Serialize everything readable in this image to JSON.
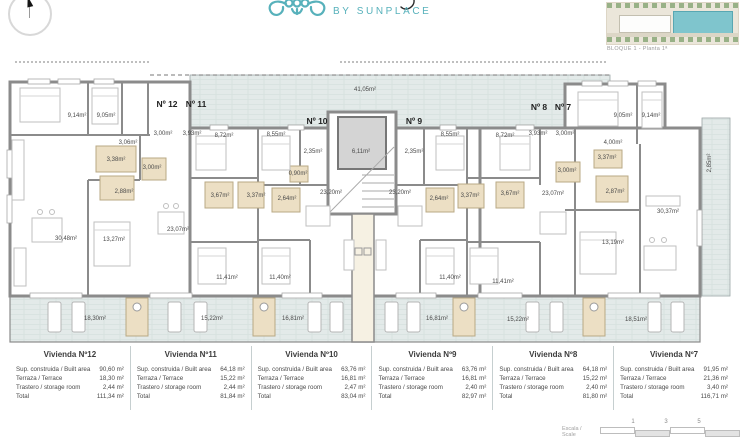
{
  "brand": {
    "tagline": "BY SUNPLACE",
    "accent_color": "#57b1bb"
  },
  "sitemap": {
    "caption": "BLOQUE 1 - Planta 1ª",
    "highlight_color": "#7fc5cd"
  },
  "colors": {
    "wall": "#8b8b8b",
    "terrace_fill": "#e3eae9",
    "bath_fill": "#ecdfc4"
  },
  "plan": {
    "unit_labels": [
      {
        "t": "Nº 12",
        "x": 167,
        "y": 104
      },
      {
        "t": "Nº 11",
        "x": 196,
        "y": 104
      },
      {
        "t": "Nº 10",
        "x": 317,
        "y": 121
      },
      {
        "t": "Nº 9",
        "x": 414,
        "y": 121
      },
      {
        "t": "Nº 8",
        "x": 539,
        "y": 107
      },
      {
        "t": "Nº 7",
        "x": 563,
        "y": 107
      }
    ],
    "room_labels": [
      {
        "t": "9,14m²",
        "x": 77,
        "y": 116
      },
      {
        "t": "9,05m²",
        "x": 106,
        "y": 116
      },
      {
        "t": "3,06m²",
        "x": 128,
        "y": 143
      },
      {
        "t": "3,38m²",
        "x": 116,
        "y": 160
      },
      {
        "t": "2,88m²",
        "x": 124,
        "y": 192
      },
      {
        "t": "30,48m²",
        "x": 66,
        "y": 239
      },
      {
        "t": "13,27m²",
        "x": 114,
        "y": 240
      },
      {
        "t": "18,30m²",
        "x": 95,
        "y": 319
      },
      {
        "t": "3,00m²",
        "x": 163,
        "y": 134
      },
      {
        "t": "3,93m²",
        "x": 192,
        "y": 134
      },
      {
        "t": "8,72m²",
        "x": 224,
        "y": 136
      },
      {
        "t": "3,00m²",
        "x": 152,
        "y": 168
      },
      {
        "t": "3,67m²",
        "x": 220,
        "y": 196
      },
      {
        "t": "3,37m²",
        "x": 256,
        "y": 196
      },
      {
        "t": "23,07m²",
        "x": 178,
        "y": 230
      },
      {
        "t": "11,41m²",
        "x": 227,
        "y": 278
      },
      {
        "t": "15,22m²",
        "x": 212,
        "y": 319
      },
      {
        "t": "8,55m²",
        "x": 276,
        "y": 135
      },
      {
        "t": "2,35m²",
        "x": 313,
        "y": 152
      },
      {
        "t": "0,90m²",
        "x": 298,
        "y": 174
      },
      {
        "t": "2,64m²",
        "x": 287,
        "y": 199
      },
      {
        "t": "23,20m²",
        "x": 331,
        "y": 193
      },
      {
        "t": "11,40m²",
        "x": 280,
        "y": 278
      },
      {
        "t": "16,81m²",
        "x": 293,
        "y": 319
      },
      {
        "t": "41,05m²",
        "x": 365,
        "y": 90
      },
      {
        "t": "6,11m²",
        "x": 361,
        "y": 152
      },
      {
        "t": "8,55m²",
        "x": 450,
        "y": 135
      },
      {
        "t": "2,35m²",
        "x": 414,
        "y": 152
      },
      {
        "t": "2,64m²",
        "x": 439,
        "y": 199
      },
      {
        "t": "23,20m²",
        "x": 400,
        "y": 193
      },
      {
        "t": "3,37m²",
        "x": 470,
        "y": 196
      },
      {
        "t": "11,40m²",
        "x": 450,
        "y": 278
      },
      {
        "t": "16,81m²",
        "x": 437,
        "y": 319
      },
      {
        "t": "8,72m²",
        "x": 505,
        "y": 136
      },
      {
        "t": "3,93m²",
        "x": 538,
        "y": 134
      },
      {
        "t": "3,00m²",
        "x": 565,
        "y": 134
      },
      {
        "t": "3,67m²",
        "x": 510,
        "y": 194
      },
      {
        "t": "23,07m²",
        "x": 553,
        "y": 194
      },
      {
        "t": "3,00m²",
        "x": 567,
        "y": 171
      },
      {
        "t": "11,41m²",
        "x": 503,
        "y": 282
      },
      {
        "t": "15,22m²",
        "x": 518,
        "y": 320
      },
      {
        "t": "9,05m²",
        "x": 623,
        "y": 116
      },
      {
        "t": "9,14m²",
        "x": 651,
        "y": 116
      },
      {
        "t": "4,00m²",
        "x": 613,
        "y": 143
      },
      {
        "t": "3,37m²",
        "x": 607,
        "y": 158
      },
      {
        "t": "2,87m²",
        "x": 615,
        "y": 192
      },
      {
        "t": "30,37m²",
        "x": 668,
        "y": 212
      },
      {
        "t": "13,19m²",
        "x": 613,
        "y": 243
      },
      {
        "t": "18,51m²",
        "x": 636,
        "y": 320
      },
      {
        "t": "2,85m²",
        "x": 710,
        "y": 163,
        "r": 90
      }
    ]
  },
  "table": {
    "row_labels": [
      "Sup. construida / Built area",
      "Terraza / Terrace",
      "Trastero / storage room",
      "Total"
    ],
    "units": [
      {
        "title": "Vivienda Nº12",
        "values": [
          "90,60 m²",
          "18,30 m²",
          "2,44 m²",
          "111,34 m²"
        ]
      },
      {
        "title": "Vivienda Nº11",
        "values": [
          "64,18 m²",
          "15,22 m²",
          "2,44 m²",
          "81,84 m²"
        ]
      },
      {
        "title": "Vivienda Nº10",
        "values": [
          "63,76 m²",
          "16,81 m²",
          "2,47 m²",
          "83,04 m²"
        ]
      },
      {
        "title": "Vivienda Nº9",
        "values": [
          "63,76 m²",
          "16,81 m²",
          "2,40 m²",
          "82,97 m²"
        ]
      },
      {
        "title": "Vivienda Nº8",
        "values": [
          "64,18 m²",
          "15,22 m²",
          "2,40 m²",
          "81,80 m²"
        ]
      },
      {
        "title": "Vivienda Nº7",
        "values": [
          "91,95 m²",
          "21,36 m²",
          "3,40 m²",
          "116,71 m²"
        ]
      }
    ]
  },
  "scale_bar": {
    "label": "Escala / Scale",
    "ticks": [
      "1",
      "3",
      "5"
    ]
  }
}
